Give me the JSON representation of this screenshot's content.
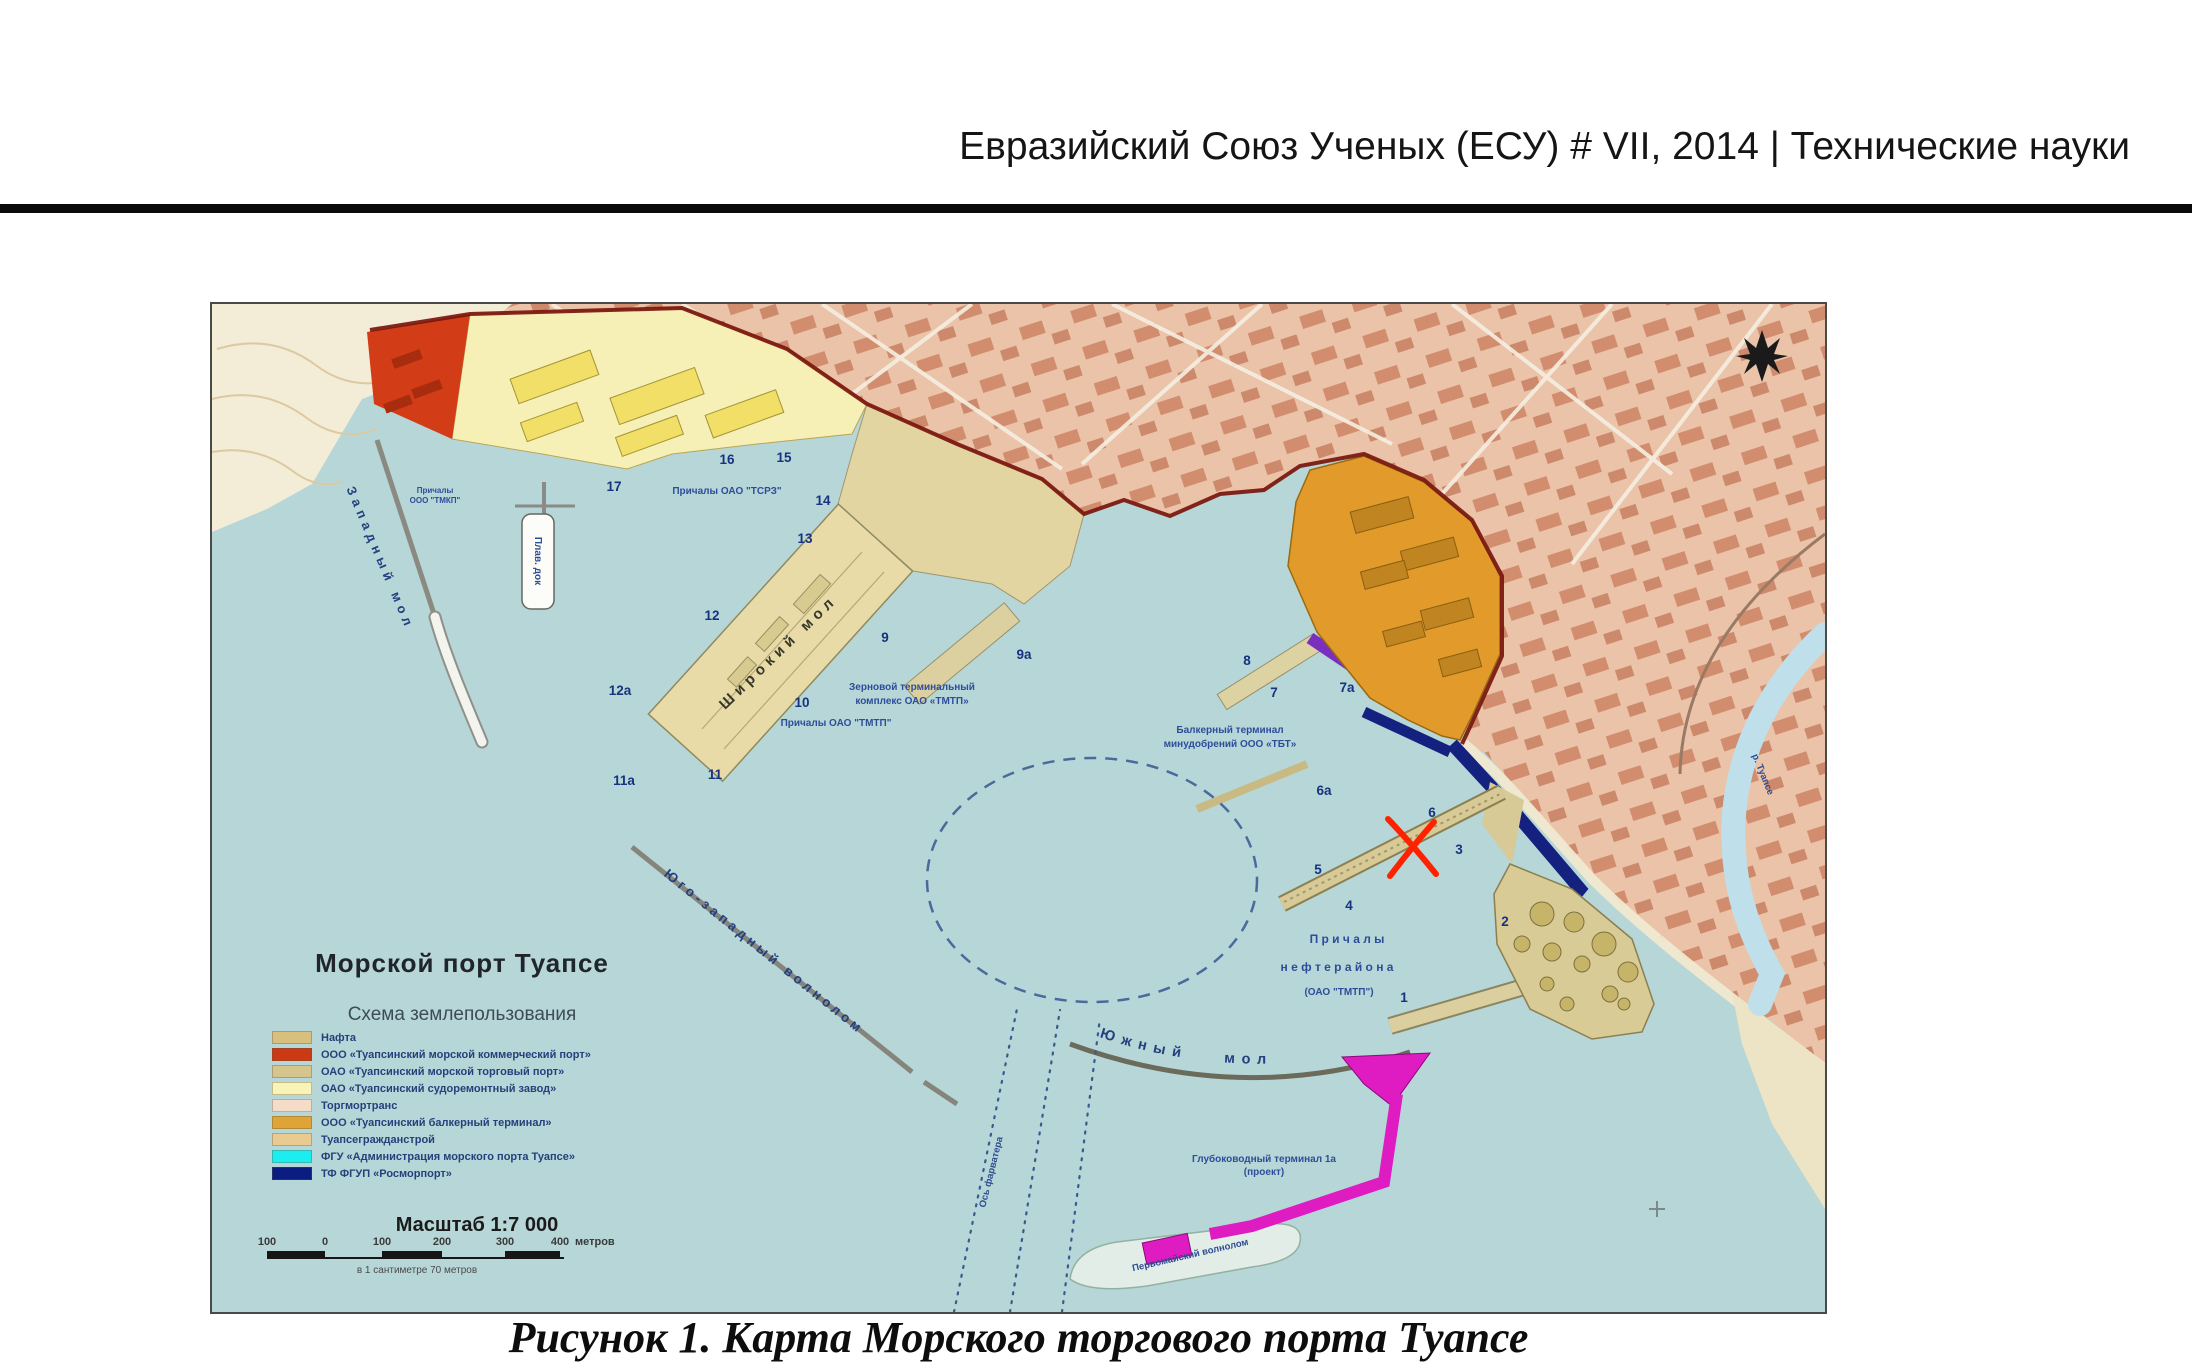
{
  "page": {
    "header": "Евразийский Союз Ученых (ЕСУ) # VII, 2014 | Технические науки",
    "figure_caption": "Рисунок 1. Карта Морского торгового порта Туапсе"
  },
  "map": {
    "title": "Морской порт Туапсе",
    "subtitle": "Схема землепользования",
    "legend": [
      {
        "label": "Нафта",
        "color": "#d9bf7d"
      },
      {
        "label": "ООО «Туапсинский морской коммерческий порт»",
        "color": "#cc3a14"
      },
      {
        "label": "ОАО «Туапсинский морской торговый порт»",
        "color": "#d5c58c"
      },
      {
        "label": "ОАО «Туапсинский судоремонтный завод»",
        "color": "#f9f3b5"
      },
      {
        "label": "Торгмортранс",
        "color": "#f4dcc8"
      },
      {
        "label": "ООО «Туапсинский балкерный терминал»",
        "color": "#dfa336"
      },
      {
        "label": "Туапсегражданстрой",
        "color": "#e9cb92"
      },
      {
        "label": "ФГУ «Администрация морского порта Туапсе»",
        "color": "#1ceef0"
      },
      {
        "label": "ТФ ФГУП «Росморпорт»",
        "color": "#0c1d82"
      }
    ],
    "scale": {
      "title": "Масштаб 1:7 000",
      "ticks": [
        "100",
        "0",
        "100",
        "200",
        "300",
        "400"
      ],
      "unit": "метров",
      "note": "в 1 сантиметре 70 метров"
    },
    "labels": {
      "west_mole": "Западный мол",
      "wide_mole": "Широкий мол",
      "southwest_breakwater": "Юго-западный волнолом",
      "south_mole": "Южный  мол",
      "pervomaysky_breakwater": "Первомайский волнолом",
      "fairway_axis": "Ось фарватера",
      "floating_dock": "Плав. док",
      "tmkp_berths_line1": "Причалы",
      "tmkp_berths_line2": "ООО \"ТМКП\"",
      "tsrz_berths": "Причалы ОАО \"ТСРЗ\"",
      "tmtp_berths": "Причалы ОАО \"ТМТП\"",
      "grain_terminal_line1": "Зерновой терминальный",
      "grain_terminal_line2": "комплекс ОАО «ТМТП»",
      "bulk_terminal_line1": "Балкерный терминал",
      "bulk_terminal_line2": "минудобрений ООО «ТБТ»",
      "oil_berths_line1": "П р и ч а л ы",
      "oil_berths_line2": "н е ф т е р а й о н а",
      "oil_berths_line3": "(ОАО \"ТМТП\")",
      "deepwater_terminal_line1": "Глубоководный терминал 1а",
      "deepwater_terminal_line2": "(проект)",
      "river": "р. Туапсе"
    },
    "berths": [
      "1",
      "2",
      "3",
      "4",
      "5",
      "6",
      "6а",
      "7",
      "7а",
      "8",
      "9",
      "9а",
      "10",
      "11",
      "11а",
      "12",
      "12а",
      "13",
      "14",
      "15",
      "16",
      "17"
    ]
  }
}
